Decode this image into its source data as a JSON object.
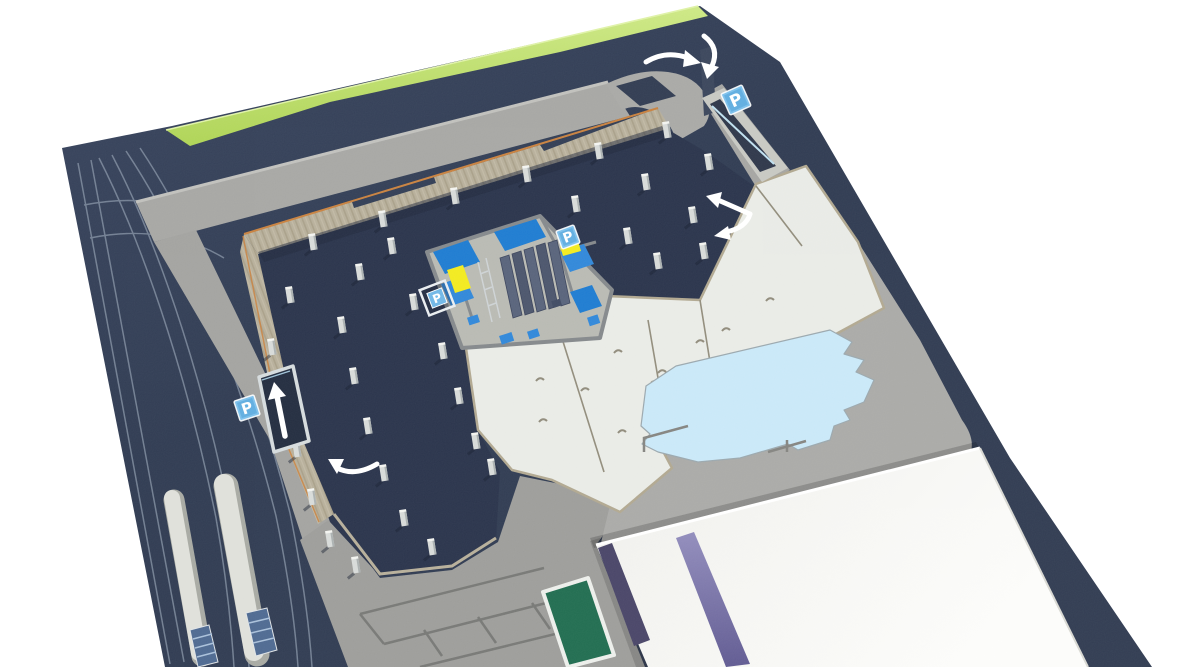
{
  "scene": {
    "description": "Aerial 3D architectural rendering of an underground automated parking facility: excavated pit with pile columns, central car-lift machinery, entry and exit ramps, glass skylight pool, tram platforms and adjacent white building",
    "view": "aerial-perspective",
    "background": "#ffffff"
  },
  "palette": {
    "street_navy": "#303c52",
    "pit_navy": "#273149",
    "grass_green": "#b6db5e",
    "road_gray": "#a6a6a3",
    "plaza_gray": "#9c9c99",
    "wall_tan": "#b6ae99",
    "wall_rim_orange": "#c8803d",
    "slab_white": "#e9ebe6",
    "pool_blue": "#c9e8f8",
    "building_white": "#f7f7f4",
    "accent_purple": "#837dae",
    "accent_purple_dark": "#4a4669",
    "machine_blue": "#1b7ad0",
    "accent_yellow": "#f2ea1c",
    "sign_blue": "#7cc0ec",
    "arrow_white": "#ffffff",
    "platform_gray": "#dcddd7",
    "stair_hatch_blue": "#4c6890",
    "planter_green": "#1e6b4e"
  },
  "parking_signs": {
    "label": "P",
    "items": [
      {
        "id": "ramp-entry-sign",
        "x": 736,
        "y": 100,
        "rotation": -24,
        "size": 23,
        "variant": "panel"
      },
      {
        "id": "machine-east-sign",
        "x": 568,
        "y": 237,
        "rotation": -20,
        "size": 19,
        "variant": "panel"
      },
      {
        "id": "machine-west-ground-sign",
        "x": 437,
        "y": 298,
        "rotation": -21,
        "size": 27,
        "variant": "ground"
      },
      {
        "id": "tram-ramp-sign",
        "x": 247,
        "y": 408,
        "rotation": -18,
        "size": 21,
        "variant": "panel"
      }
    ]
  },
  "arrows": [
    {
      "name": "entry-curve-arrow",
      "meaning": "traffic curving right into site entrance"
    },
    {
      "name": "ramp-down-arrow",
      "meaning": "hook arrow turning down onto the descending ramp"
    },
    {
      "name": "split-direction-arrow",
      "meaning": "double-headed arrow showing two movement directions in the pit"
    },
    {
      "name": "exit-ramp-up-arrow",
      "meaning": "straight up arrow in the exit ramp box"
    },
    {
      "name": "pit-entry-curve-arrow",
      "meaning": "curved arrow turning left into the excavation"
    }
  ],
  "pillars": [
    [
      313,
      243
    ],
    [
      383,
      220
    ],
    [
      455,
      197
    ],
    [
      527,
      175
    ],
    [
      599,
      152
    ],
    [
      667,
      131
    ],
    [
      290,
      296
    ],
    [
      360,
      273
    ],
    [
      392,
      247
    ],
    [
      576,
      205
    ],
    [
      646,
      183
    ],
    [
      709,
      163
    ],
    [
      272,
      348
    ],
    [
      342,
      326
    ],
    [
      414,
      303
    ],
    [
      628,
      237
    ],
    [
      693,
      216
    ],
    [
      283,
      400
    ],
    [
      354,
      377
    ],
    [
      443,
      352
    ],
    [
      658,
      262
    ],
    [
      704,
      252
    ],
    [
      297,
      450
    ],
    [
      368,
      427
    ],
    [
      459,
      397
    ],
    [
      312,
      498
    ],
    [
      384,
      474
    ],
    [
      476,
      442
    ],
    [
      330,
      540
    ],
    [
      404,
      519
    ],
    [
      492,
      468
    ],
    [
      356,
      566
    ],
    [
      432,
      548
    ]
  ],
  "slab_anchors": [
    [
      585,
      390
    ],
    [
      622,
      432
    ],
    [
      543,
      421
    ],
    [
      662,
      372
    ],
    [
      700,
      342
    ],
    [
      618,
      352
    ],
    [
      586,
      330
    ],
    [
      540,
      380
    ],
    [
      726,
      330
    ],
    [
      770,
      300
    ]
  ]
}
